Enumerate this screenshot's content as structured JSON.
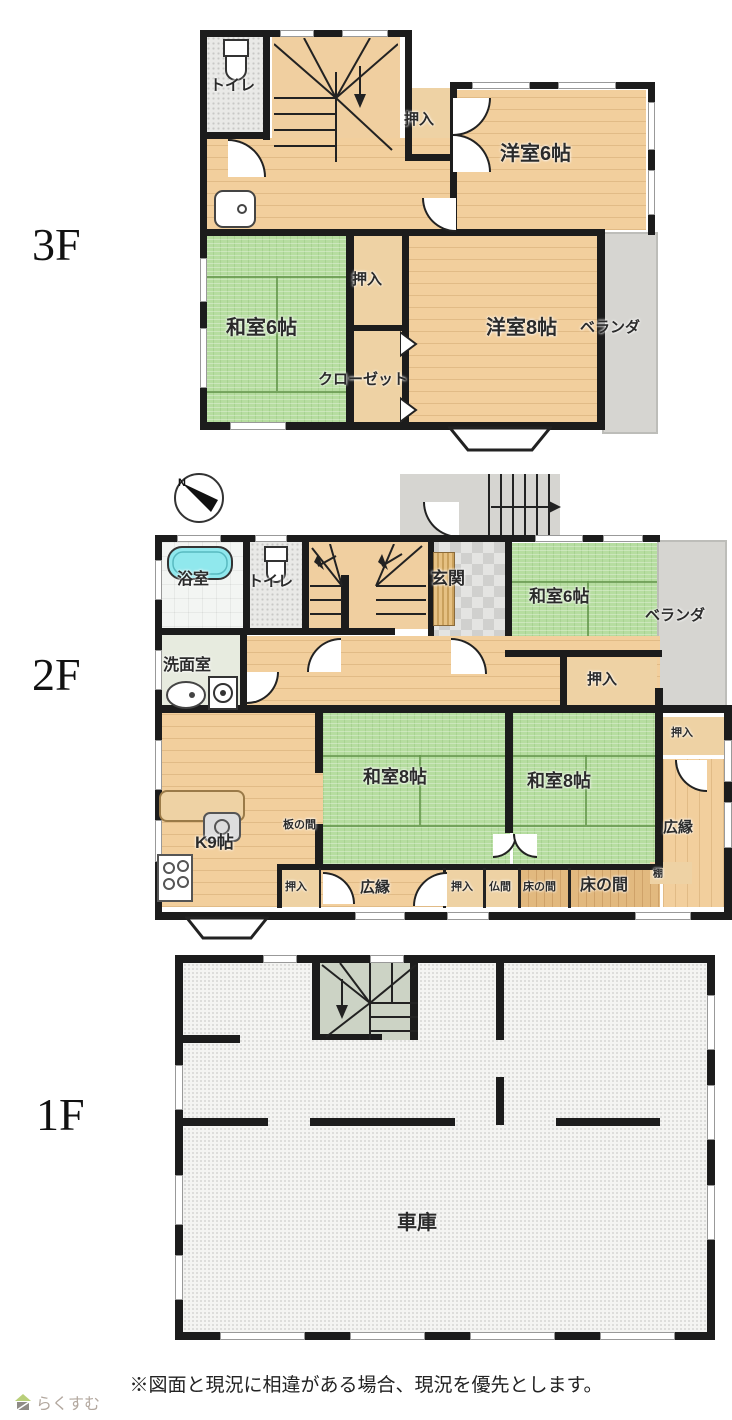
{
  "colors": {
    "wood": "#f2cf9d",
    "wood_dark": "#e2b97f",
    "tatami": "#b6dda0",
    "wall": "#1c1c1c",
    "veranda": "#d6d5d1",
    "tub": "#90e8ed",
    "closet": "#eed2a4",
    "stairs_1f": "#ccd3c5",
    "speckle": "#e9e9e7",
    "garage": "#f4f4f2",
    "pale": "#e7ebdf"
  },
  "f3": {
    "floor": "3F",
    "toilet": "トイレ",
    "oshiire_top": "押入",
    "yoshitsu6": "洋室6帖",
    "washitsu6": "和室6帖",
    "oshiire_mid": "押入",
    "closet": "クローゼット",
    "yoshitsu8": "洋室8帖",
    "veranda": "ベランダ"
  },
  "f2": {
    "floor": "2F",
    "bath": "浴室",
    "toilet": "トイレ",
    "genkan": "玄関",
    "washitsu6": "和室6帖",
    "veranda": "ベランダ",
    "senmen": "洗面室",
    "oshiire_top": "押入",
    "k9": "K9帖",
    "itanoma": "板の間",
    "washitsu8_left": "和室8帖",
    "washitsu8_right": "和室8帖",
    "oshiire_right": "押入",
    "hiroen_right": "広縁",
    "oshiire_b1": "押入",
    "hiroen_b": "広縁",
    "oshiire_b2": "押入",
    "butsuma": "仏間",
    "tokonoma_small": "床の間",
    "tokonoma_large": "床の間",
    "tana": "棚"
  },
  "f1": {
    "floor": "1F",
    "garage": "車庫"
  },
  "compass": {
    "north": "N"
  },
  "footer": {
    "disclaimer": "※図面と現況に相違がある場合、現況を優先とします。",
    "logo": "らくすむ"
  }
}
